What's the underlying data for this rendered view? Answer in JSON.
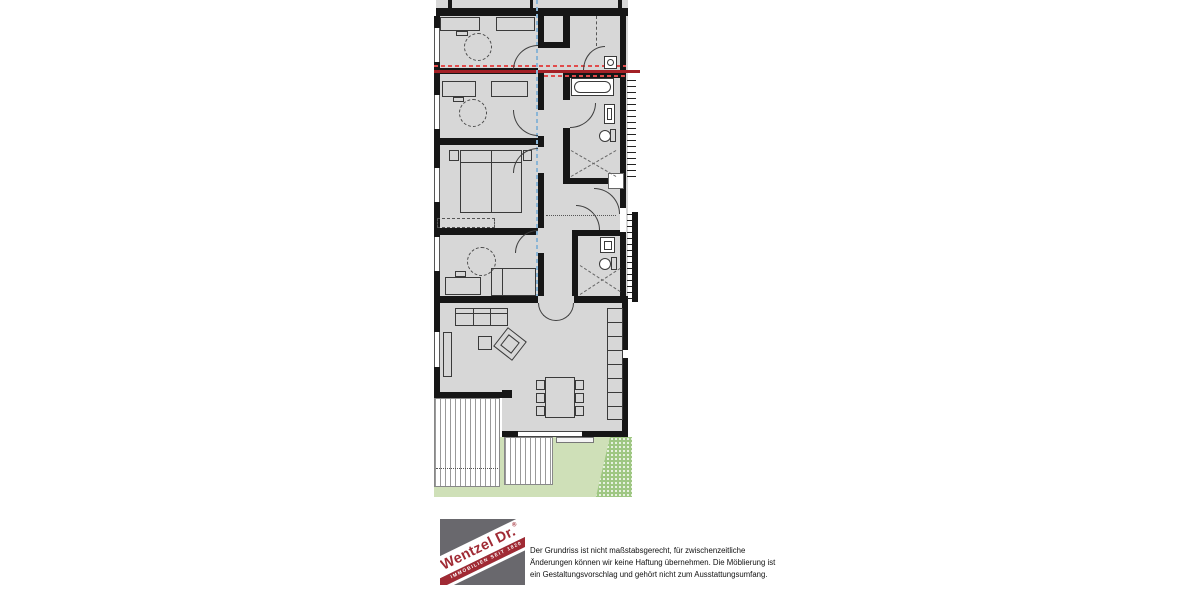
{
  "colors": {
    "wall": "#161616",
    "floor": "#d7d7d7",
    "lawn": "#cfe0b8",
    "shrub": "#9fc783",
    "deck_stripe": "#9a9a9a",
    "outline": "#3a3a3a",
    "section_red": "#a32026",
    "section_red_dash": "#e14b4b",
    "axis_blue": "#8ab5d6",
    "logo_gray": "#69686d",
    "logo_red": "#a02a34"
  },
  "footer": {
    "logo": {
      "brand": "Wentzel Dr.",
      "registered_mark": "®",
      "tagline": "IMMOBILIEN SEIT 1820"
    },
    "disclaimer": {
      "lines": [
        "Der Grundriss ist nicht maßstabsgerecht, für zwischenzeitliche",
        "Änderungen können wir keine Haftung übernehmen. Die Möblierung ist",
        "ein Gestaltungsvorschlag und gehört nicht zum Ausstattungsumfang."
      ]
    }
  }
}
